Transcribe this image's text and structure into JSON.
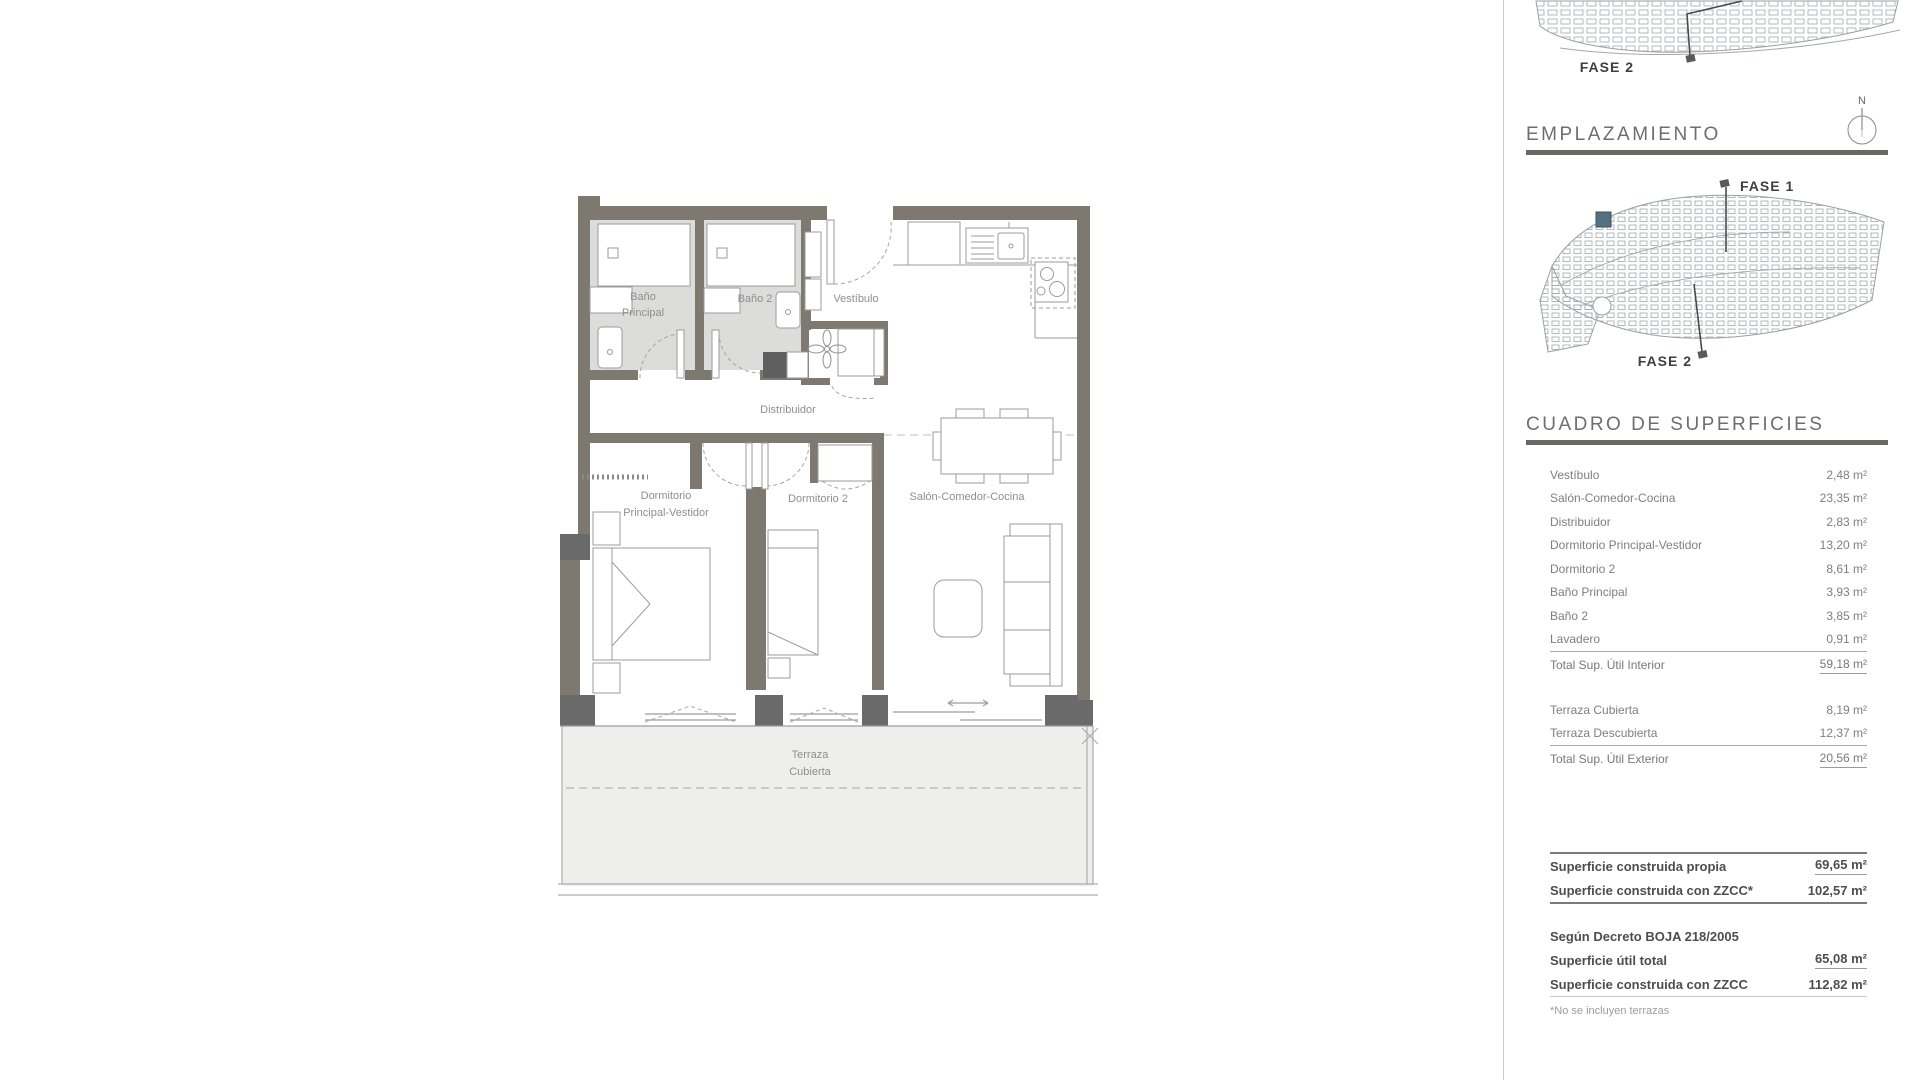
{
  "colors": {
    "wall": "#7d7971",
    "pillar": "#6a6a6a",
    "bath_floor": "#dcdcda",
    "terrace_floor": "#eeeeed",
    "highlight_unit": "#56707f",
    "divider_line": "#cdcdcd"
  },
  "floor_plan": {
    "labels": {
      "bano_principal_l1": "Baño",
      "bano_principal_l2": "Principal",
      "bano2": "Baño 2",
      "vestibulo": "Vestíbulo",
      "distribuidor": "Distribuidor",
      "dorm_principal_l1": "Dormitorio",
      "dorm_principal_l2": "Principal-Vestidor",
      "dormitorio2": "Dormitorio 2",
      "salon": "Salón-Comedor-Cocina",
      "terraza_l1": "Terraza",
      "terraza_l2": "Cubierta"
    }
  },
  "sidebar": {
    "location": {
      "title": "EMPLAZAMIENTO",
      "compass_n": "N",
      "overview_fase2": "FASE 2",
      "fase1": "FASE 1",
      "fase2": "FASE 2"
    },
    "surfaces": {
      "title": "CUADRO DE SUPERFICIES",
      "rows": [
        {
          "label": "Vestíbulo",
          "value": "2,48 m²"
        },
        {
          "label": "Salón-Comedor-Cocina",
          "value": "23,35 m²"
        },
        {
          "label": "Distribuidor",
          "value": "2,83 m²"
        },
        {
          "label": "Dormitorio Principal-Vestidor",
          "value": "13,20 m²"
        },
        {
          "label": "Dormitorio 2",
          "value": "8,61 m²"
        },
        {
          "label": "Baño Principal",
          "value": "3,93 m²"
        },
        {
          "label": "Baño 2",
          "value": "3,85 m²"
        },
        {
          "label": "Lavadero",
          "value": "0,91 m²"
        }
      ],
      "interior_total": {
        "label": "Total Sup. Útil Interior",
        "value": "59,18 m²"
      },
      "exterior_rows": [
        {
          "label": "Terraza Cubierta",
          "value": "8,19 m²"
        },
        {
          "label": "Terraza Descubierta",
          "value": "12,37 m²"
        }
      ],
      "exterior_total": {
        "label": "Total Sup. Útil Exterior",
        "value": "20,56 m²"
      },
      "built_rows": [
        {
          "label": "Superficie construida propia",
          "value": "69,65 m²"
        },
        {
          "label": "Superficie construida con ZZCC*",
          "value": "102,57 m²"
        }
      ],
      "decree": {
        "heading": "Según Decreto BOJA 218/2005",
        "rows": [
          {
            "label": "Superficie útil total",
            "value": "65,08 m²"
          },
          {
            "label": "Superficie construida con ZZCC",
            "value": "112,82 m²"
          }
        ]
      },
      "footnote": "*No se incluyen terrazas"
    }
  }
}
